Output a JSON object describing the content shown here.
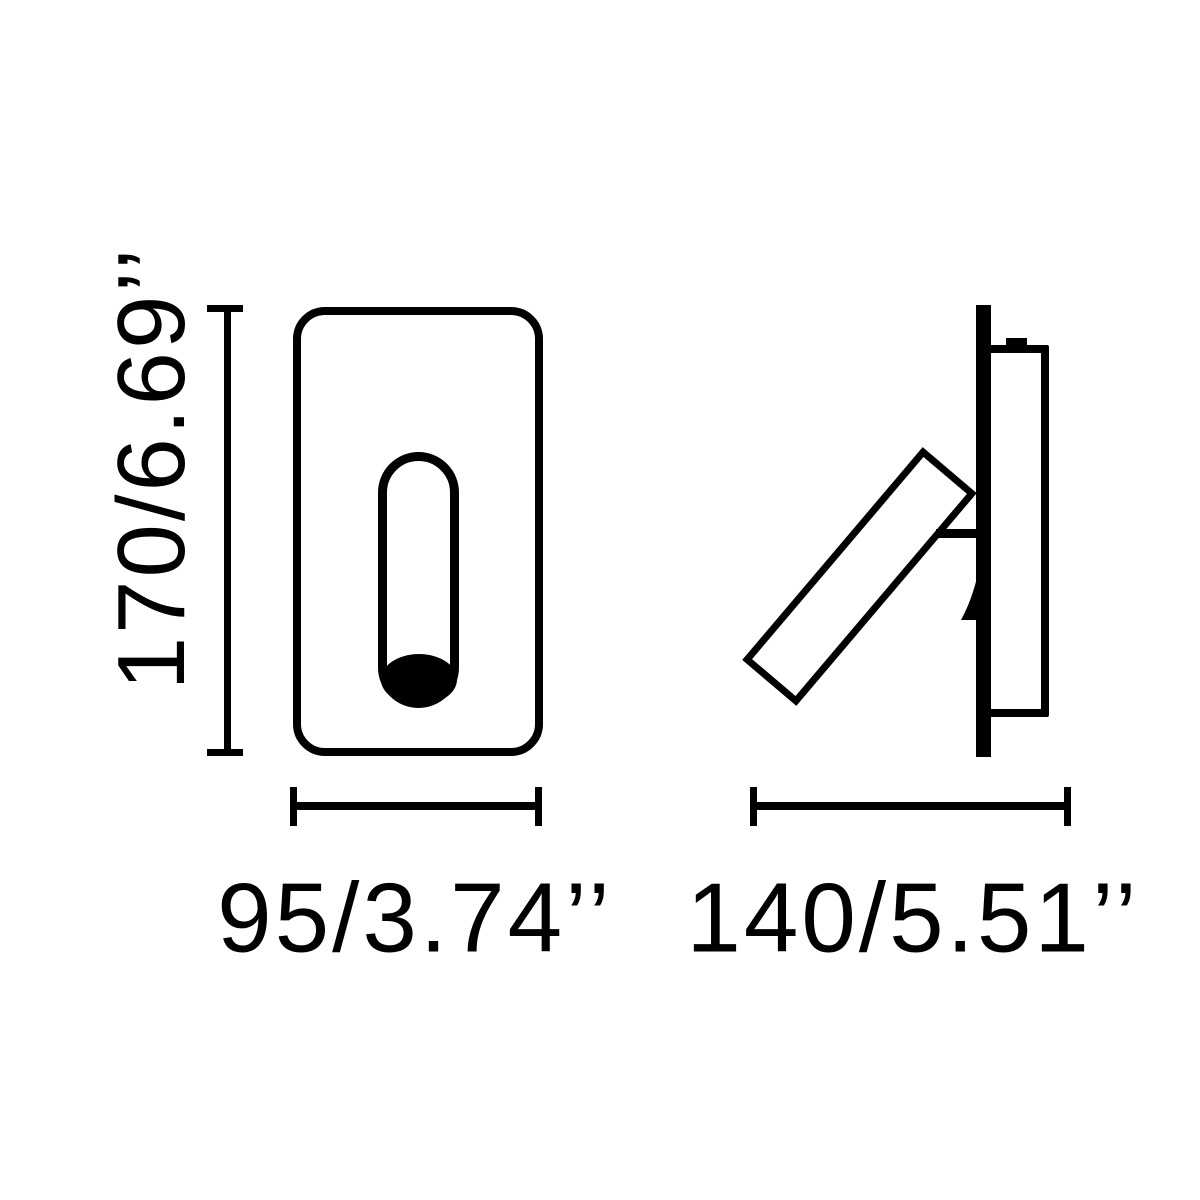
{
  "page": {
    "background": "#ffffff",
    "line_color": "#000000",
    "description_not_rendered": ""
  },
  "views": {
    "front": {
      "height_dim_label": "170/6.69’’",
      "width_dim_label": "95/3.74’’"
    },
    "side": {
      "width_dim_label": "140/5.51’’"
    }
  }
}
